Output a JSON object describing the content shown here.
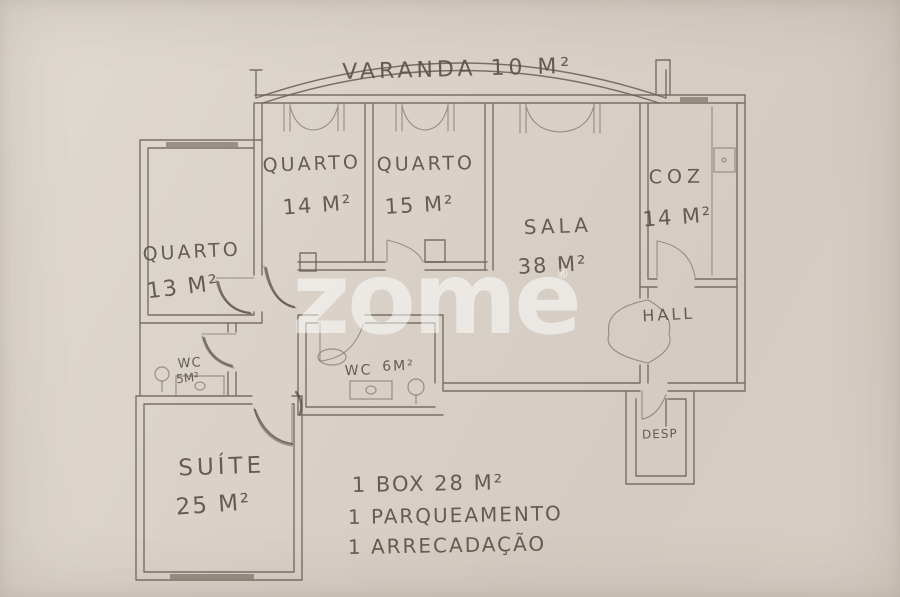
{
  "palette": {
    "paper": "#d9d1c8",
    "pencil": "#6b6156",
    "pencil_dark": "#4c4338",
    "handwriting": "#5b5348",
    "watermark": "#ffffff"
  },
  "watermark": {
    "text": "zome",
    "mark": "®"
  },
  "rooms": {
    "varanda": {
      "name": "VARANDA",
      "area": "10 M²"
    },
    "quarto13": {
      "name": "QUARTO",
      "area": "13 M²"
    },
    "quarto14": {
      "name": "QUARTO",
      "area": "14 M²"
    },
    "quarto15": {
      "name": "QUARTO",
      "area": "15 M²"
    },
    "sala": {
      "name": "SALA",
      "area": "38 M²"
    },
    "coz": {
      "name": "COZ",
      "area": "14 M²"
    },
    "hall": {
      "name": "HALL"
    },
    "wc5": {
      "name": "WC",
      "area": "5M²"
    },
    "wc6": {
      "name": "WC",
      "area": "6M²"
    },
    "suite": {
      "name": "SUÍTE",
      "area": "25 M²"
    },
    "desp": {
      "name": "DESP"
    }
  },
  "notes": [
    {
      "text": "1 BOX  28 M²"
    },
    {
      "text": "1 PARQUEAMENTO"
    },
    {
      "text": "1 ARRECADAÇÃO"
    }
  ]
}
